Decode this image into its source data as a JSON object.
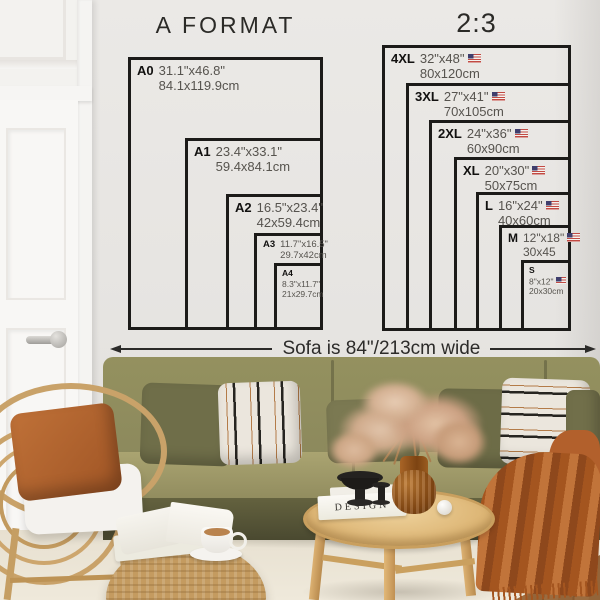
{
  "left_chart": {
    "title": "A FORMAT",
    "items": [
      {
        "label": "A0",
        "inches": "31.1\"x46.8\"",
        "cm": "84.1x119.9cm"
      },
      {
        "label": "A1",
        "inches": "23.4\"x33.1\"",
        "cm": "59.4x84.1cm"
      },
      {
        "label": "A2",
        "inches": "16.5\"x23.4\"",
        "cm": "42x59.4cm"
      },
      {
        "label": "A3",
        "inches": "11.7\"x16.5\"",
        "cm": "29.7x42cm"
      },
      {
        "label": "A4",
        "inches": "8.3\"x11.7\"",
        "cm": "21x29.7cm"
      }
    ]
  },
  "right_chart": {
    "title": "2:3",
    "items": [
      {
        "label": "4XL",
        "inches": "32\"x48\"",
        "cm": "80x120cm",
        "flag": "us"
      },
      {
        "label": "3XL",
        "inches": "27\"x41\"",
        "cm": "70x105cm",
        "flag": "us"
      },
      {
        "label": "2XL",
        "inches": "24\"x36\"",
        "cm": "60x90cm",
        "flag": "us"
      },
      {
        "label": "XL",
        "inches": "20\"x30\"",
        "cm": "50x75cm",
        "flag": "us"
      },
      {
        "label": "L",
        "inches": "16\"x24\"",
        "cm": "40x60cm",
        "flag": "us"
      },
      {
        "label": "M",
        "inches": "12\"x18\"",
        "cm": "30x45",
        "flag": "us"
      },
      {
        "label": "S",
        "inches": "8\"x12\"",
        "cm": "20x30cm",
        "flag": "us"
      }
    ]
  },
  "annotation": {
    "sofa_width": "Sofa is 84\"/213cm wide"
  },
  "scene": {
    "book_title": "DESIGN"
  },
  "colors": {
    "chart_line": "#1c1b19",
    "wall": "#e7e5e2",
    "sofa_olive": "#8e8c61",
    "pillow_olive": "#6f6e49",
    "throw_rust": "#b2602c",
    "rattan": "#c9a269",
    "table_wood": "#d9af6c",
    "flag_blue": "#3f3e6d",
    "flag_red": "#c24a43"
  }
}
